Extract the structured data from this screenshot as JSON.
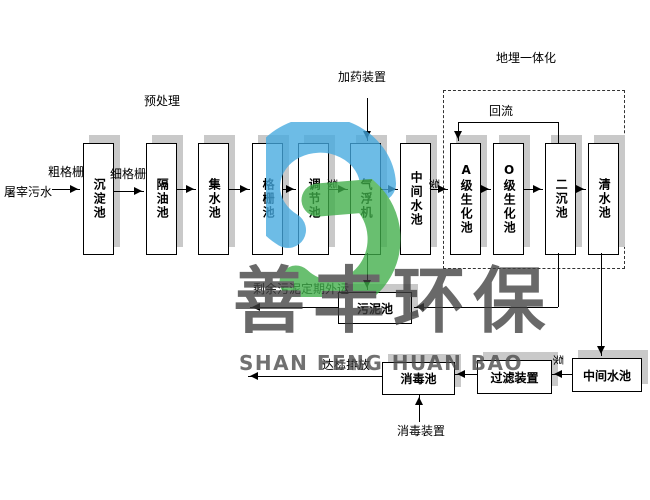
{
  "diagram": {
    "influent_label": "屠宰污水",
    "pretreatment_label": "预处理",
    "coarse_screen_label": "粗格栅",
    "fine_screen_label": "细格栅",
    "dosing_device_label": "加药装置",
    "buried_integration_label": "地埋一体化",
    "reflux_label": "回流",
    "pump_label": "泵",
    "excess_sludge_label": "剩余污泥定期外运",
    "discharge_label": "达标排放",
    "disinfection_device_label": "消毒装置",
    "tanks": [
      {
        "id": "sedimentation",
        "label": "沉淀池"
      },
      {
        "id": "oil-separation",
        "label": "隔油池"
      },
      {
        "id": "collecting",
        "label": "集水池"
      },
      {
        "id": "screen",
        "label": "格栅池"
      },
      {
        "id": "regulating",
        "label": "调节池"
      },
      {
        "id": "air-flotation",
        "label": "气浮机"
      },
      {
        "id": "intermediate",
        "label": "中间水池"
      },
      {
        "id": "a-biochemical",
        "label": "A级生化池"
      },
      {
        "id": "o-biochemical",
        "label": "O级生化池"
      },
      {
        "id": "secondary-sedimentation",
        "label": "二沉池"
      },
      {
        "id": "clear-water",
        "label": "清水池"
      },
      {
        "id": "sludge",
        "label": "污泥池"
      },
      {
        "id": "disinfection",
        "label": "消毒池"
      },
      {
        "id": "filter-device",
        "label": "过滤装置"
      },
      {
        "id": "intermediate-2",
        "label": "中间水池"
      }
    ]
  },
  "watermark": {
    "company_cn": "善丰环保",
    "company_en": "SHAN FENG HUAN BAO"
  },
  "colors": {
    "logo_blue": "#45aae0",
    "logo_green": "#3fae49",
    "box_shadow": "#c9c9c9",
    "watermark_text": "#3f3f3f"
  }
}
